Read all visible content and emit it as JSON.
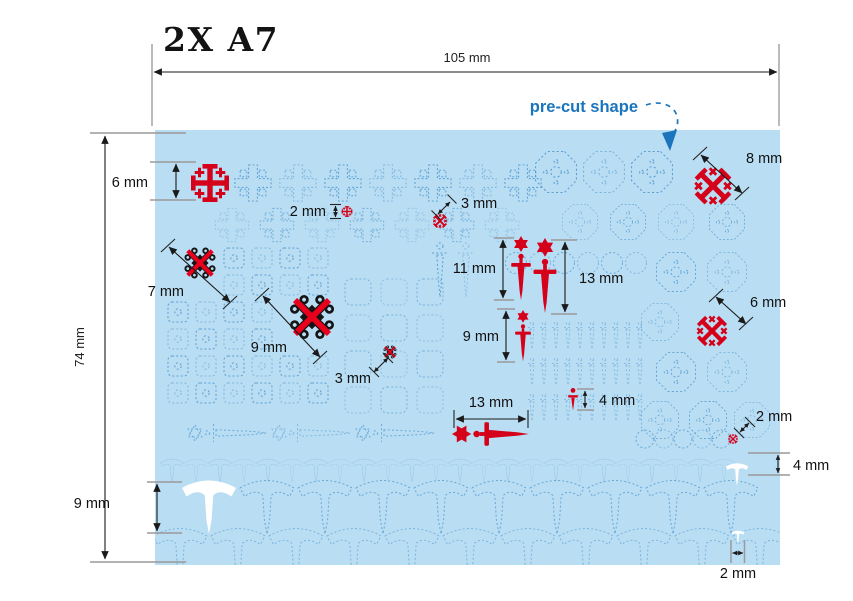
{
  "title": "2X A7",
  "callout": {
    "label": "pre-cut shape"
  },
  "sheet": {
    "name": "A7 pre-cut decal sheet",
    "width_label": "105 mm",
    "height_label": "74 mm",
    "colors": {
      "sheet": "#b9ddf2",
      "outline_blue": "#4a94cf",
      "highlight_red": "#d50019",
      "highlight_black": "#151515",
      "highlight_white": "#ffffff",
      "callout_blue": "#1b75bc"
    }
  },
  "annotations": [
    {
      "id": "jerusalem-cross-large",
      "shape": "jerusalem cross",
      "color": "red",
      "label": "6 mm"
    },
    {
      "id": "jerusalem-cross-tiny",
      "shape": "jerusalem cross",
      "color": "red",
      "label": "2 mm"
    },
    {
      "id": "saltire-cross-small",
      "shape": "saltire cross",
      "color": "red",
      "label": "3 mm"
    },
    {
      "id": "ornate-square-small",
      "shape": "ornate square",
      "color": "black",
      "label": "7 mm"
    },
    {
      "id": "ornate-square-large",
      "shape": "ornate square",
      "color": "black",
      "label": "9 mm"
    },
    {
      "id": "ornate-square-tiny",
      "shape": "ornate square",
      "color": "black",
      "label": "3 mm"
    },
    {
      "id": "sword-star-medium",
      "shape": "sword with star",
      "color": "red",
      "label": "11 mm"
    },
    {
      "id": "sword-star-large",
      "shape": "sword with star",
      "color": "red",
      "label": "13 mm"
    },
    {
      "id": "sword-star-small",
      "shape": "sword with star",
      "color": "red",
      "label": "9 mm"
    },
    {
      "id": "saltire-cross-large",
      "shape": "saltire cross",
      "color": "red",
      "label": "8 mm"
    },
    {
      "id": "saltire-cross-medium",
      "shape": "saltire cross",
      "color": "red",
      "label": "6 mm"
    },
    {
      "id": "sword-horizontal",
      "shape": "sword with star",
      "color": "red",
      "label": "13 mm"
    },
    {
      "id": "dagger-tiny",
      "shape": "dagger",
      "color": "red",
      "label": "4 mm"
    },
    {
      "id": "saltire-cross-tiny",
      "shape": "saltire cross",
      "color": "red",
      "label": "2 mm"
    },
    {
      "id": "anchor-tee-small",
      "shape": "anchor tee",
      "color": "white",
      "label": "4 mm"
    },
    {
      "id": "anchor-tee-large",
      "shape": "anchor tee",
      "color": "white",
      "label": "9 mm"
    },
    {
      "id": "anchor-tee-tiny",
      "shape": "anchor tee",
      "color": "white",
      "label": "2 mm"
    }
  ]
}
